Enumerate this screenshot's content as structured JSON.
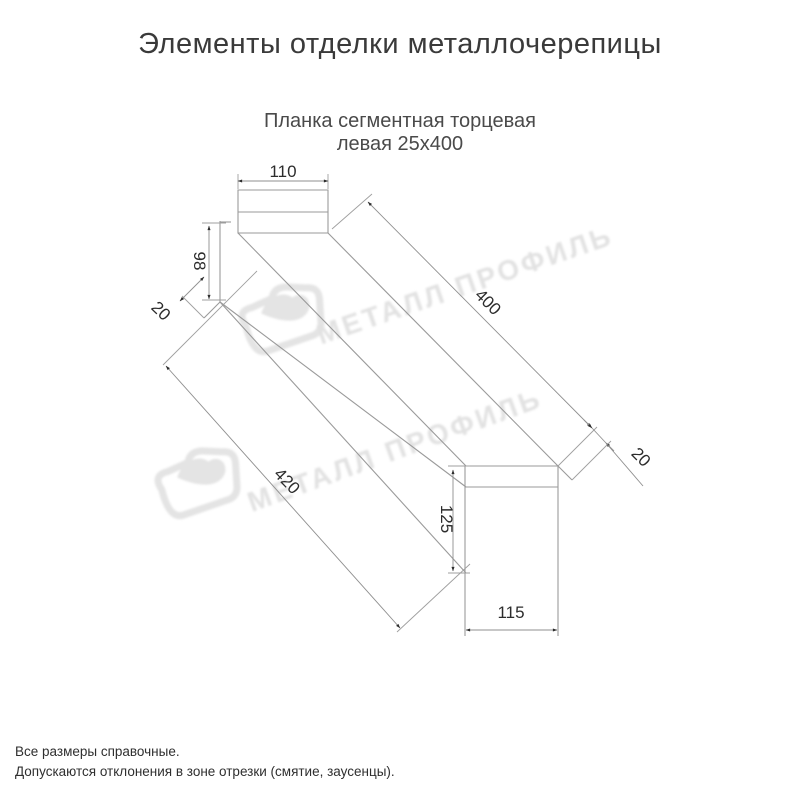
{
  "header": {
    "title": "Элементы отделки металлочерепицы"
  },
  "drawing": {
    "subtitle_line1": "Планка сегментная торцевая",
    "subtitle_line2": "левая 25х400",
    "dimensions": {
      "top_width": "110",
      "left_height": "98",
      "left_fold": "20",
      "length_top": "400",
      "length_bottom": "420",
      "right_height": "125",
      "right_width": "115",
      "right_fold": "20"
    },
    "watermark": {
      "text": "МЕТАЛЛ ПРОФИЛЬ",
      "color": "#e2e2e2"
    },
    "line_color": "#9a9a9a",
    "dim_text_color": "#2c2c2c"
  },
  "footer": {
    "line1": "Все размеры справочные.",
    "line2": "Допускаются отклонения в зоне отрезки (смятие, заусенцы)."
  }
}
